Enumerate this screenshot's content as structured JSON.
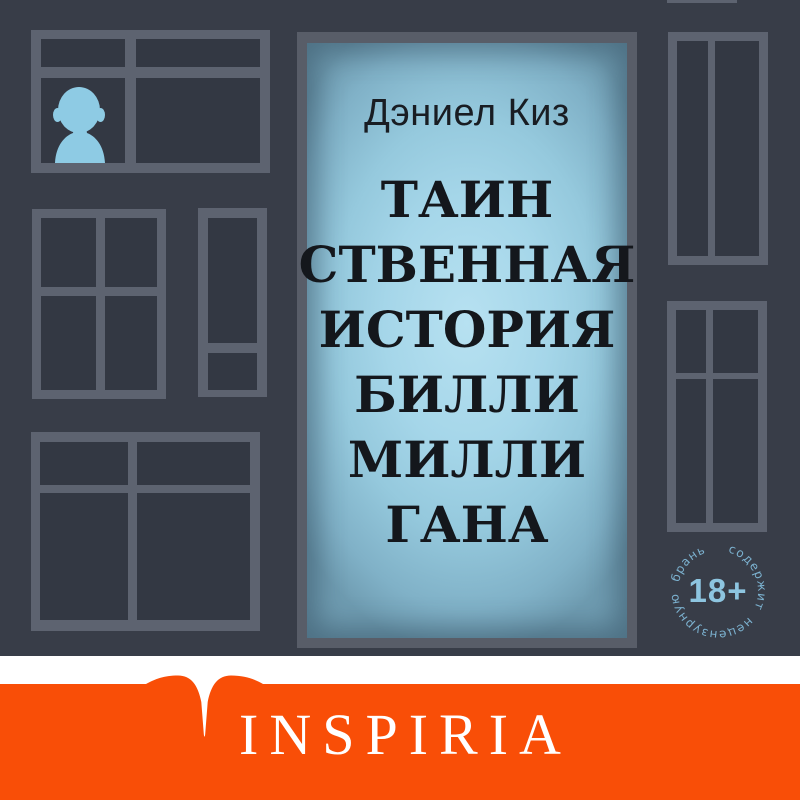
{
  "cover": {
    "author": "Дэниел Киз",
    "title_lines": [
      "ТАИН",
      "СТВЕННАЯ",
      "ИСТОРИЯ",
      "БИЛЛИ",
      "МИЛЛИ",
      "ГАНА"
    ],
    "age_badge": {
      "label": "18+",
      "ring_text": "содержит нецензурную брань"
    },
    "publisher_logo_text": "INSPIRIA",
    "icons": {
      "person": "person-silhouette-icon",
      "open_book": "open-book-logo-icon",
      "age_badge": "age-restriction-badge"
    },
    "colors": {
      "background": "#383d48",
      "frame_gray": "#5d6370",
      "door_frame_gray": "#585d68",
      "panel_blue": "#a5d6e9",
      "accent_blue": "#8ecbe4",
      "badge_blue": "#7cb2d0",
      "orange": "#f94e07",
      "white_band": "#ffffff",
      "title_text": "#14171c"
    }
  }
}
